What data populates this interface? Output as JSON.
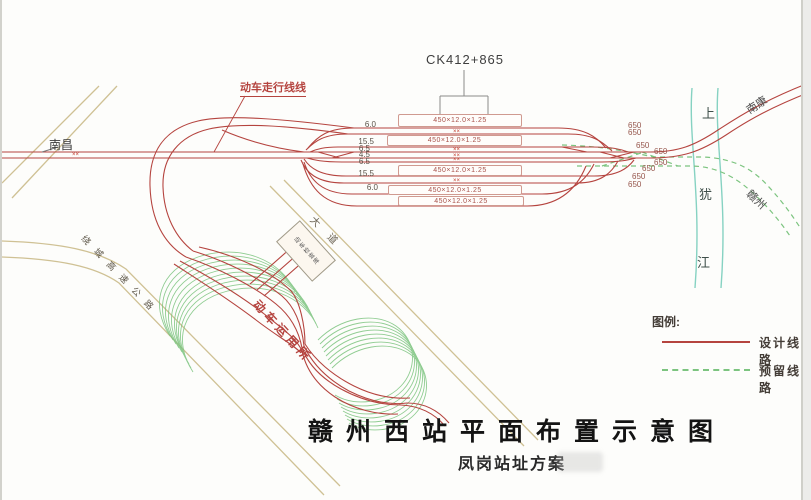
{
  "annotations": {
    "chainage": "CK412+865",
    "walking_line": "动车走行线线",
    "depot": "动车运用所",
    "depot_building": "动车检查库",
    "left_destination": "南昌",
    "top_right_destination": "南康",
    "bottom_right_destination": "赣州"
  },
  "river": {
    "name": "上犹江",
    "chars": [
      "上",
      "犹",
      "江"
    ]
  },
  "roads": {
    "expressway": "绕城高速公路",
    "avenue": "大道"
  },
  "station": {
    "platform_label": "450×12.0×1.25",
    "track_length_label": "650",
    "center_mark": "××",
    "spacings": [
      "6.0",
      "15.5",
      "6.5",
      "4.5",
      "6.5",
      "15.5",
      "6.0"
    ]
  },
  "legend": {
    "title": "图例:",
    "items": [
      {
        "label": "设计线路",
        "style": "solid",
        "color": "#b5443f"
      },
      {
        "label": "预留线路",
        "style": "dashed",
        "color": "#7cc47f"
      }
    ]
  },
  "titles": {
    "main": "赣州西站平面布置示意图",
    "sub": "凤岗站址方案"
  },
  "colors": {
    "design_line": "#b5443f",
    "reserved_line": "#7cc47f",
    "river": "#86d2c2",
    "road": "#cfc194",
    "platform_border": "#d09a90",
    "number_gray": "#5a5248",
    "length_brown": "#96564c"
  }
}
